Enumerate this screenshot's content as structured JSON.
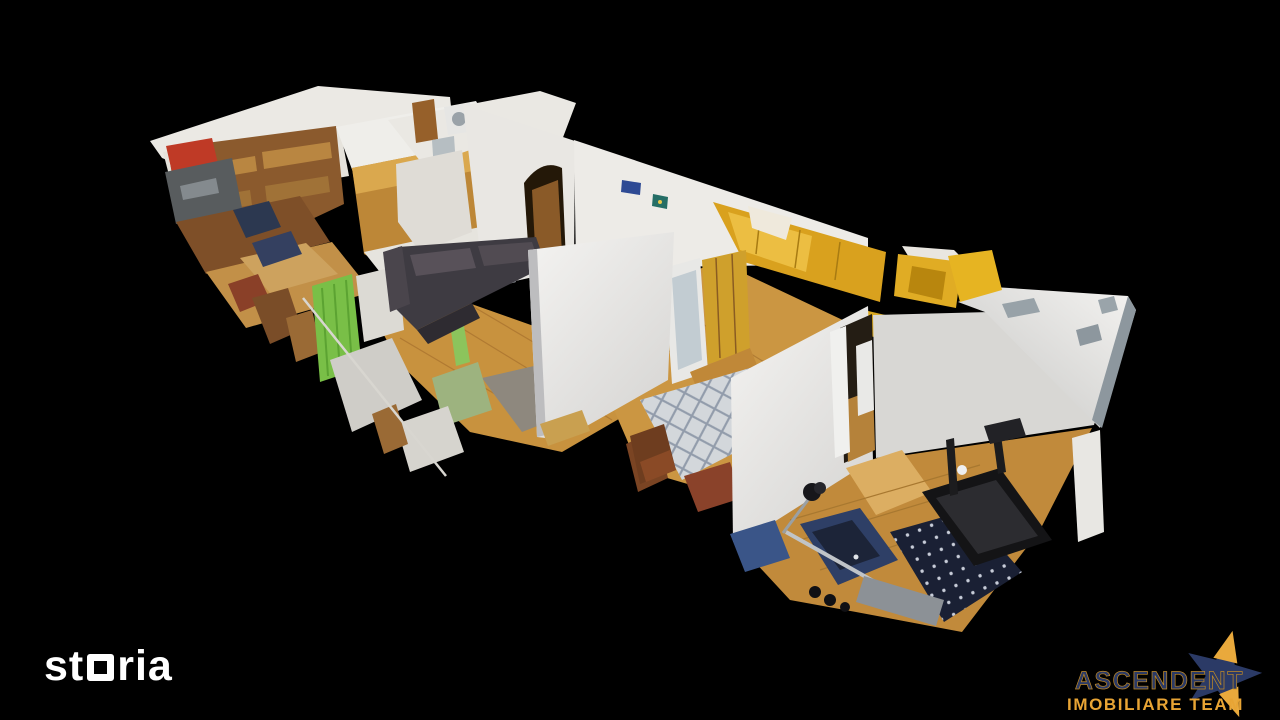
{
  "canvas": {
    "width": 1280,
    "height": 720,
    "background": "#000000"
  },
  "scene": {
    "alt": "3D dollhouse cutaway scan of an apartment (kitchen, living room, bedroom, hallway, gym room)",
    "palette": {
      "wood_floor": "#c8923e",
      "wall_white": "#ecebe7",
      "couch": "#3e3b42",
      "green_accent": "#79bf47",
      "wardrobe_yellow": "#d9a11e",
      "bed_cover": "#d3d7db",
      "rug_navy": "#1a2034",
      "treadmill": "#141416",
      "kitchen_wood": "#bd8737",
      "red_item": "#bf3a26"
    }
  },
  "watermarks": {
    "storia": {
      "part1": "st",
      "part2": "ria",
      "full_name": "storia",
      "color": "#ffffff"
    },
    "agency": {
      "line1": "ASCENDENT",
      "line2": "IMOBILIARE TEAM",
      "navy": "#2b3a66",
      "gold": "#e9a93c"
    }
  }
}
